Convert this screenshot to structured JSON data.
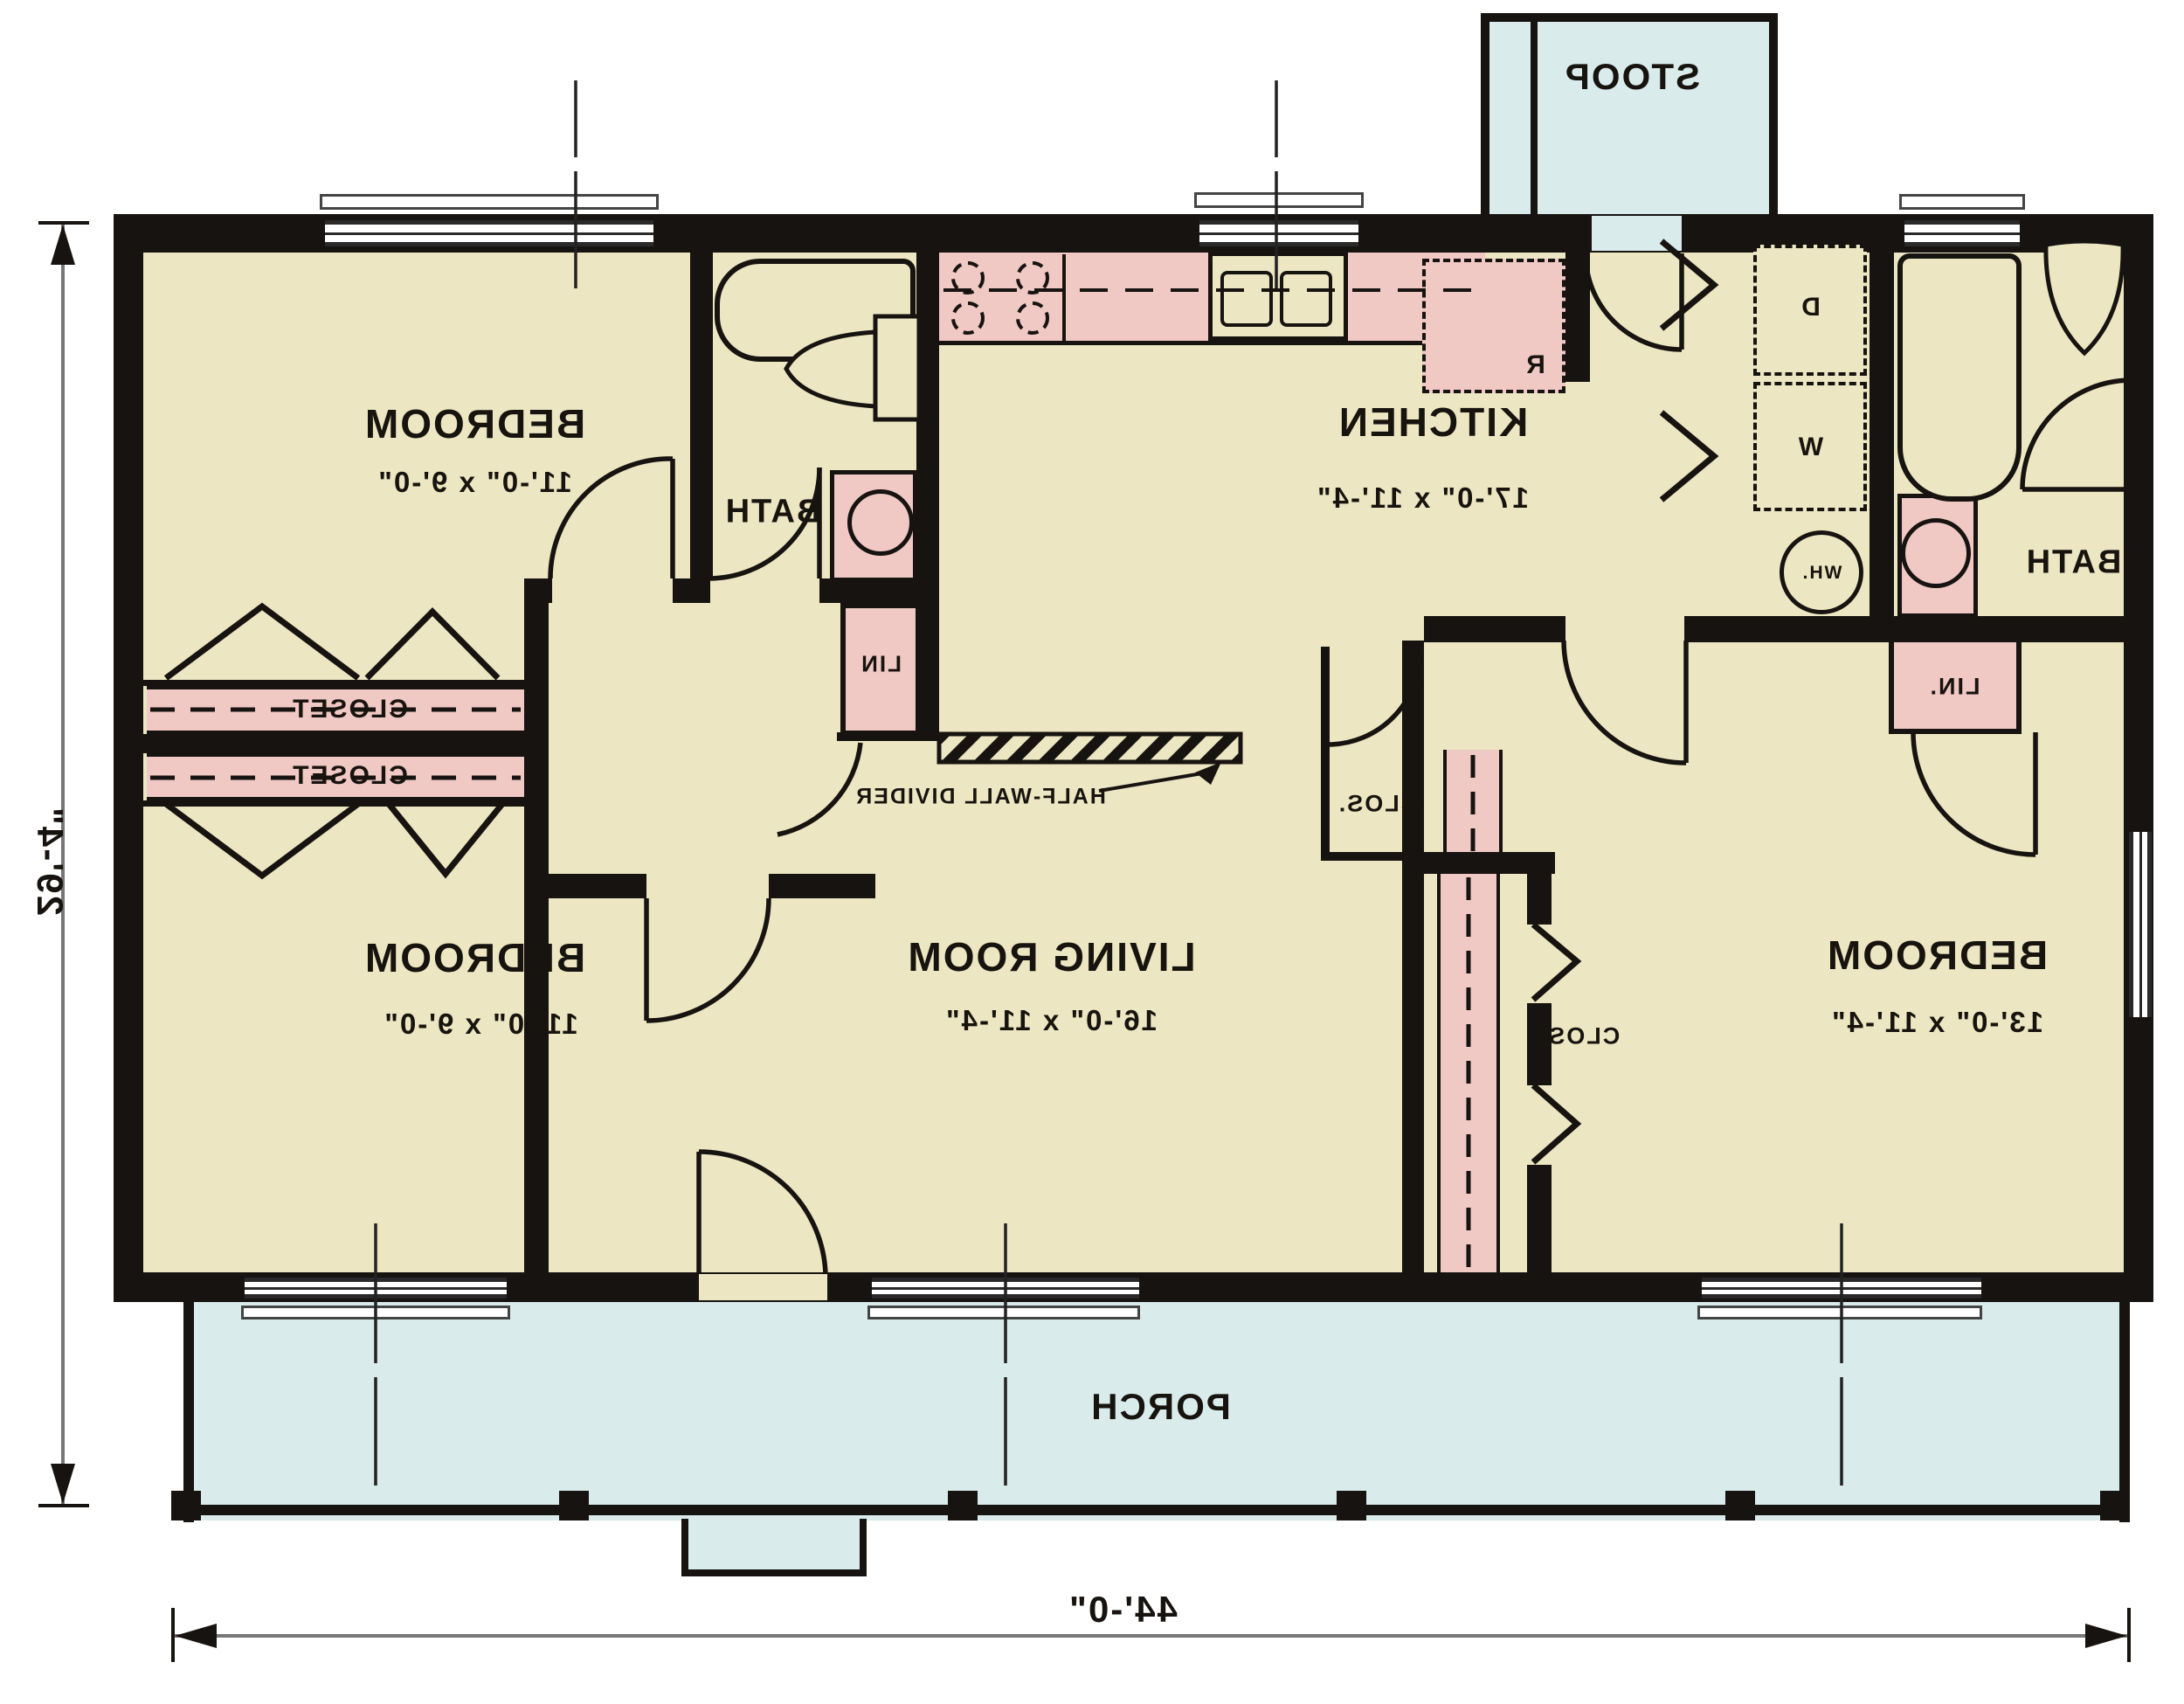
{
  "colors": {
    "wall": "#171310",
    "floor": "#ece7c2",
    "porch": "#d9ebeb",
    "fixture_pink": "#f0c8c4",
    "dimension_line": "#777777"
  },
  "rooms": {
    "bedroom1": {
      "name": "BEDROOM",
      "dims": "11'-0\" x 9'-0\""
    },
    "bedroom2": {
      "name": "BEDROOM",
      "dims": "11'-0\" x 9'-0\""
    },
    "bedroom3": {
      "name": "BEDROOM",
      "dims": "13'-0\" x 11'-4\""
    },
    "kitchen": {
      "name": "KITCHEN",
      "dims": "17'-0\" x 11'-4\""
    },
    "living_room": {
      "name": "LIVING ROOM",
      "dims": "16'-0\" x 11'-4\""
    },
    "bath_left": {
      "name": "BATH"
    },
    "bath_right": {
      "name": "BATH"
    },
    "porch": {
      "name": "PORCH"
    },
    "stoop": {
      "name": "STOOP"
    }
  },
  "closets": {
    "closet_upper": "CLOSET",
    "closet_lower": "CLOSET",
    "hall_closet": "CLOS.",
    "bedroom3_closet": "CLOS.",
    "linen_left": "LIN",
    "linen_right": "LIN."
  },
  "appliances": {
    "refrigerator": "R",
    "dryer": "D",
    "washer": "W",
    "water_heater": "WH."
  },
  "annotations": {
    "half_wall_divider": "HALF-WALL DIVIDER"
  },
  "dimensions": {
    "overall_width": "44'-0\"",
    "overall_depth": "29'-4\""
  }
}
